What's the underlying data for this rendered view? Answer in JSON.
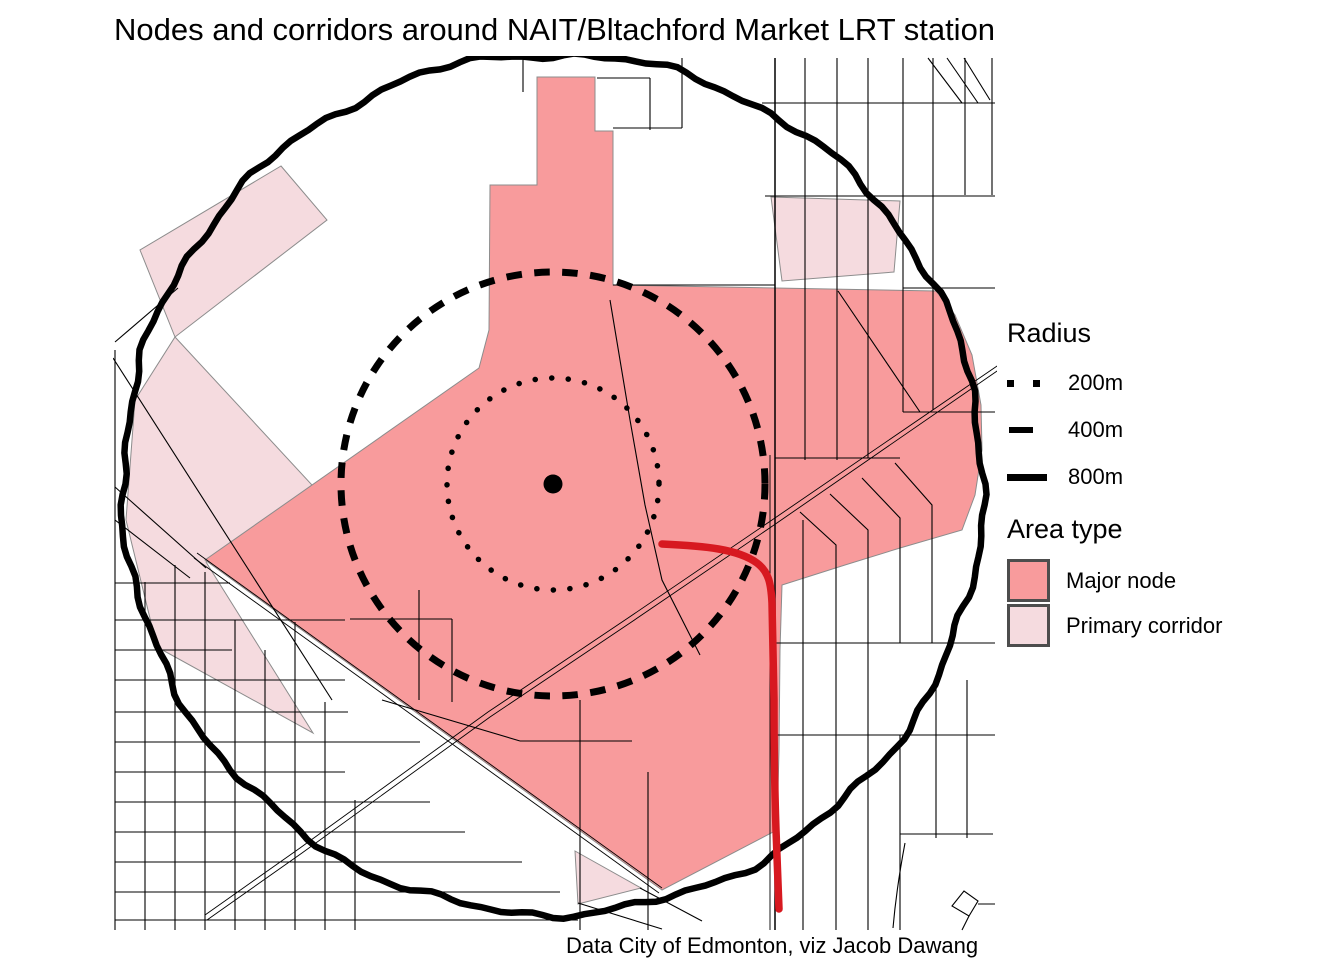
{
  "title": "Nodes and corridors around NAIT/Bltachford Market LRT station",
  "caption": "Data City of Edmonton, viz Jacob Dawang",
  "legend": {
    "radius_title": "Radius",
    "radius_items": [
      {
        "label": "200m",
        "style": "dotted"
      },
      {
        "label": "400m",
        "style": "dashed"
      },
      {
        "label": "800m",
        "style": "solid"
      }
    ],
    "area_title": "Area type",
    "area_items": [
      {
        "label": "Major node",
        "color": "#f89b9c"
      },
      {
        "label": "Primary corridor",
        "color": "#f5dbdf"
      }
    ]
  },
  "map": {
    "center_px": {
      "x": 553,
      "y": 484
    },
    "station_marker": "LRT station center point",
    "rings_px": [
      {
        "label": "200m",
        "r": 106,
        "style": "dotted"
      },
      {
        "label": "400m",
        "r": 212,
        "style": "dashed"
      },
      {
        "label": "800m",
        "r": 430,
        "style": "solid"
      }
    ],
    "colors": {
      "major_node": "#f89b9c",
      "primary_corridor": "#f5dbdf",
      "lrt_line": "#d71920",
      "ring": "#000000",
      "street": "#000000",
      "area_border": "#8c8c8c"
    }
  }
}
